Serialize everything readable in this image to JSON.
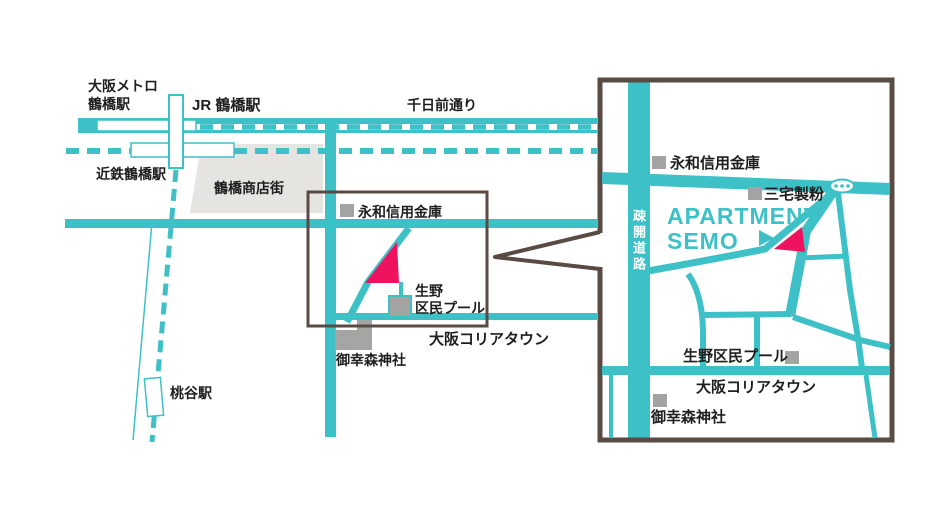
{
  "colors": {
    "teal": "#3EC1C6",
    "pink": "#EF135F",
    "frame": "#594A43",
    "gray_area": "#E5E4E1",
    "gray_building": "#A5A5A3",
    "marker": "#A3A3A3",
    "text": "#1E1E1E"
  },
  "overview_map": {
    "labels": {
      "metro_line1": "大阪メトロ",
      "metro_line2": "鶴橋駅",
      "jr_station": "JR 鶴橋駅",
      "kintetsu_station": "近鉄鶴橋駅",
      "shotengai": "鶴橋商店街",
      "sennichimae_street": "千日前通り",
      "eiwa_bank": "永和信用金庫",
      "pool_line1": "生野",
      "pool_line2": "区民プール",
      "koreatown": "大阪コリアタウン",
      "miyukimori_shrine": "御幸森神社",
      "momodani_station": "桃谷駅"
    }
  },
  "detail_map": {
    "labels": {
      "eiwa_bank": "永和信用金庫",
      "miyake_flour": "三宅製粉",
      "apartment_line1": "APARTMENT",
      "apartment_line2": "SEMO",
      "sokai_road": "疎開道路",
      "pool": "生野区民プール",
      "koreatown": "大阪コリアタウン",
      "miyukimori_shrine": "御幸森神社"
    }
  }
}
